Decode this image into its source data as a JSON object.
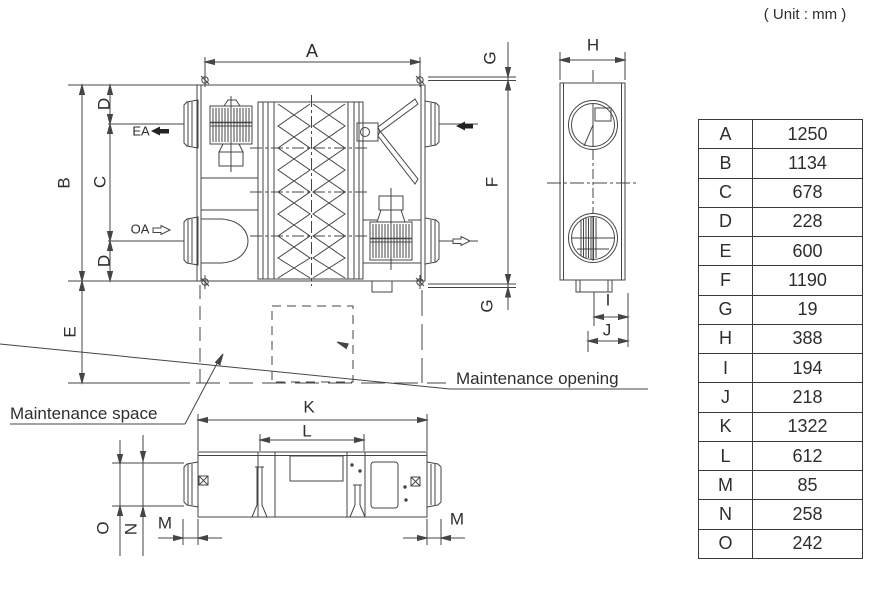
{
  "note": "( Unit : mm )",
  "drawing": {
    "dims": {
      "a": "A",
      "b": "B",
      "c": "C",
      "d_top": "D",
      "d_bottom": "D",
      "e": "E",
      "f": "F",
      "g_top": "G",
      "g_bottom": "G",
      "h": "H",
      "i": "I",
      "j": "J",
      "k": "K",
      "l": "L",
      "m_left": "M",
      "m_right": "M",
      "n": "N",
      "o": "O"
    },
    "airflow": {
      "ea": "EA",
      "oa": "OA"
    },
    "annotations": {
      "space": "Maintenance space",
      "opening": "Maintenance opening"
    }
  },
  "table": {
    "rows": [
      {
        "key": "A",
        "value": "1250"
      },
      {
        "key": "B",
        "value": "1134"
      },
      {
        "key": "C",
        "value": "678"
      },
      {
        "key": "D",
        "value": "228"
      },
      {
        "key": "E",
        "value": "600"
      },
      {
        "key": "F",
        "value": "1190"
      },
      {
        "key": "G",
        "value": "19"
      },
      {
        "key": "H",
        "value": "388"
      },
      {
        "key": "I",
        "value": "194"
      },
      {
        "key": "J",
        "value": "218"
      },
      {
        "key": "K",
        "value": "1322"
      },
      {
        "key": "L",
        "value": "612"
      },
      {
        "key": "M",
        "value": "85"
      },
      {
        "key": "N",
        "value": "258"
      },
      {
        "key": "O",
        "value": "242"
      }
    ]
  },
  "colors": {
    "line": "#454545",
    "arrow": "#222222"
  }
}
